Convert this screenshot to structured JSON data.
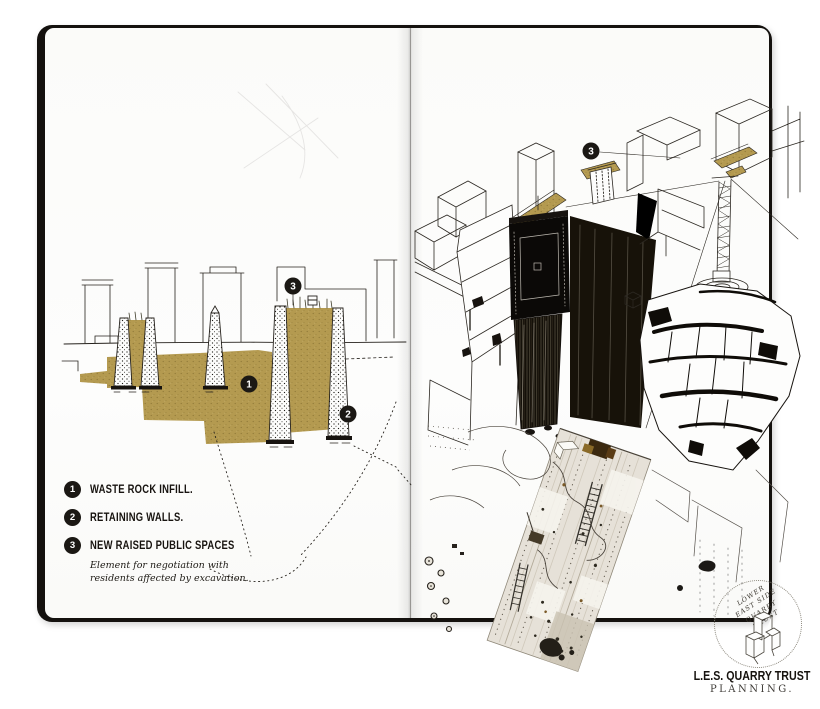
{
  "artwork": {
    "legend": {
      "items": [
        {
          "num": "1",
          "label": "WASTE ROCK INFILL."
        },
        {
          "num": "2",
          "label": "RETAINING WALLS."
        },
        {
          "num": "3",
          "label": "NEW RAISED PUBLIC SPACES",
          "note_line1": "Element for negotiation with",
          "note_line2": "residents affected by excavation."
        }
      ]
    },
    "markers": {
      "waste_rock": "1",
      "retaining_walls": "2",
      "public_spaces": "3"
    },
    "stamp": {
      "line1": "LOWER",
      "line2": "EAST SIDE",
      "line3": "QUARRY",
      "line4": "TRUST"
    },
    "footer": {
      "title": "L.E.S. QUARRY TRUST",
      "subtitle": "PLANNING."
    },
    "colors": {
      "gold_infill": "#b49a50",
      "ink": "#17130f",
      "paper": "#fcfcfa",
      "cover": "#14110e"
    }
  }
}
